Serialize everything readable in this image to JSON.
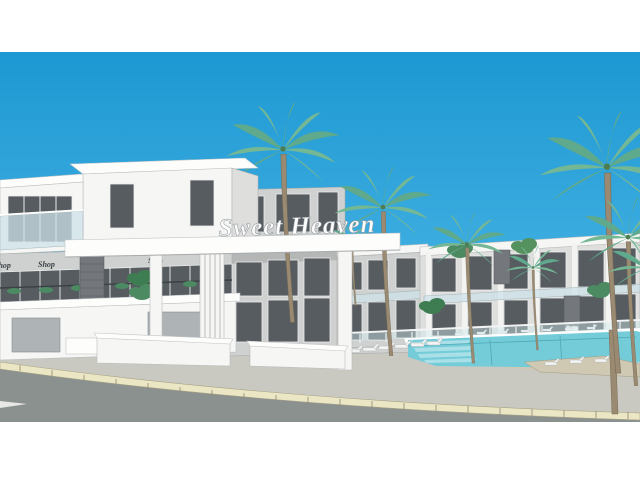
{
  "image": {
    "description_label": "Architectural rendering of resort complex",
    "project_sign": "Sweet Heaven",
    "shop_signs": [
      "Shop",
      "Shop",
      "Shop"
    ]
  },
  "colors": {
    "sky_top": "#1d98d2",
    "sky_mid": "#3dade0",
    "sky_bottom": "#85d3f0",
    "building_white": "#f6f6f4",
    "building_gray": "#cfd1d0",
    "window_dark": "#565c60",
    "stone_gray": "#74787c",
    "pool_water": "#74ccd9",
    "pool_steps": "#a9e0e8",
    "pavement": "#c9c9c1",
    "deck_warm": "#cfc8b2",
    "curb_cream": "#ebe6c4",
    "road_gray": "#8b918e",
    "palm_green": "#5fa98c",
    "palm_trunk": "#9a8a72",
    "plant_green": "#4c8a62"
  }
}
